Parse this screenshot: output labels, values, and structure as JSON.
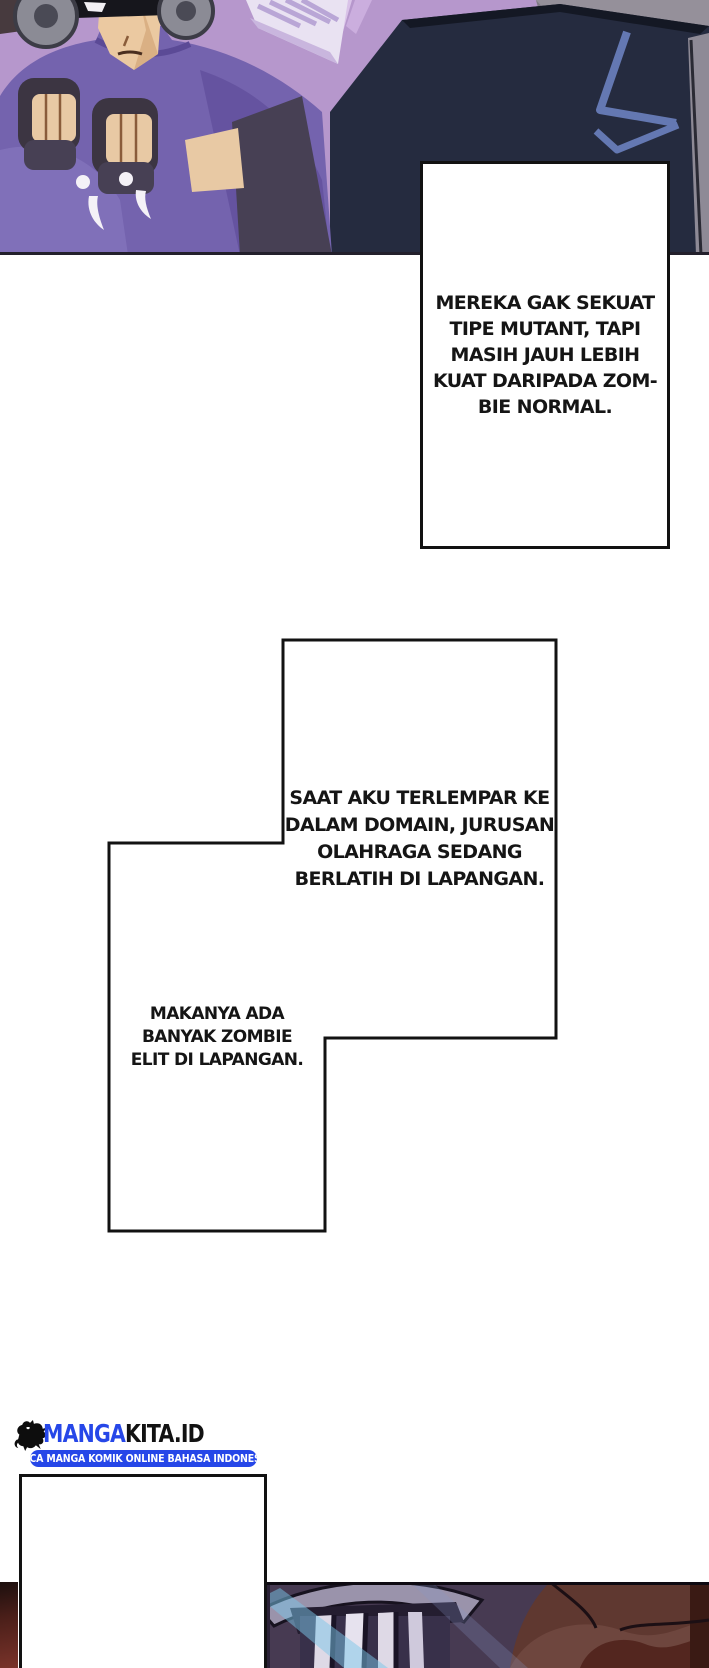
{
  "page": {
    "kind": "manga page",
    "language": "Indonesian"
  },
  "bubbles": [
    {
      "id": "bubble-1",
      "text": "MEREKA GAK SEKUAT\nTIPE MUTANT, TAPI\nMASIH JAUH LEBIH\nKUAT DARIPADA ZOM-\nBIE NORMAL."
    },
    {
      "id": "bubble-2",
      "text": "SAAT AKU TERLEMPAR KE\nDALAM DOMAIN, JURUSAN\nOLAHRAGA SEDANG\nBERLATIH DI LAPANGAN."
    },
    {
      "id": "bubble-3",
      "text": "MAKANYA ADA\nBANYAK ZOMBIE\nELIT DI LAPANGAN."
    },
    {
      "id": "bubble-4",
      "text": ""
    }
  ],
  "watermark": {
    "brand_primary": "MANGA",
    "brand_secondary": "KITA.ID",
    "tagline": "BACA MANGA KOMIK ONLINE BAHASA INDONESIA"
  },
  "artwork": {
    "top_panel": "masked fighter in purple shirt raising gloved fists, dark-uniformed figure seen from behind",
    "bottom_panel": "armored helmet grille with cyan light beam, dark red background"
  },
  "colors": {
    "brand_blue": "#2647e8",
    "bubble_border": "#121212",
    "bubble_fill": "#ffffff",
    "text": "#151515",
    "page_bg": "#ffffff"
  }
}
